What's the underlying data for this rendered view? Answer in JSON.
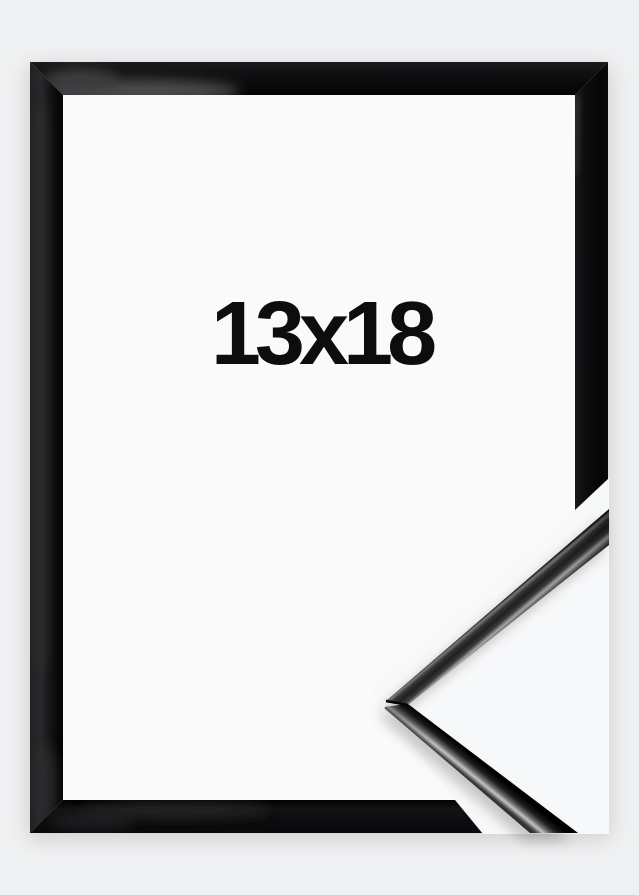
{
  "product_image": {
    "size_label": "13x18",
    "frame_style": "glossy-black-frame",
    "colors": {
      "page_background": "#eff0f1",
      "frame_black": "#0a0a0b",
      "frame_highlight": "#4b4b4d",
      "opening_white": "#fafafb",
      "corner_sample_background": "#f7f8f9",
      "corner_sample_specular": "#c8c8c8",
      "label_text": "#0d0d0e"
    }
  }
}
